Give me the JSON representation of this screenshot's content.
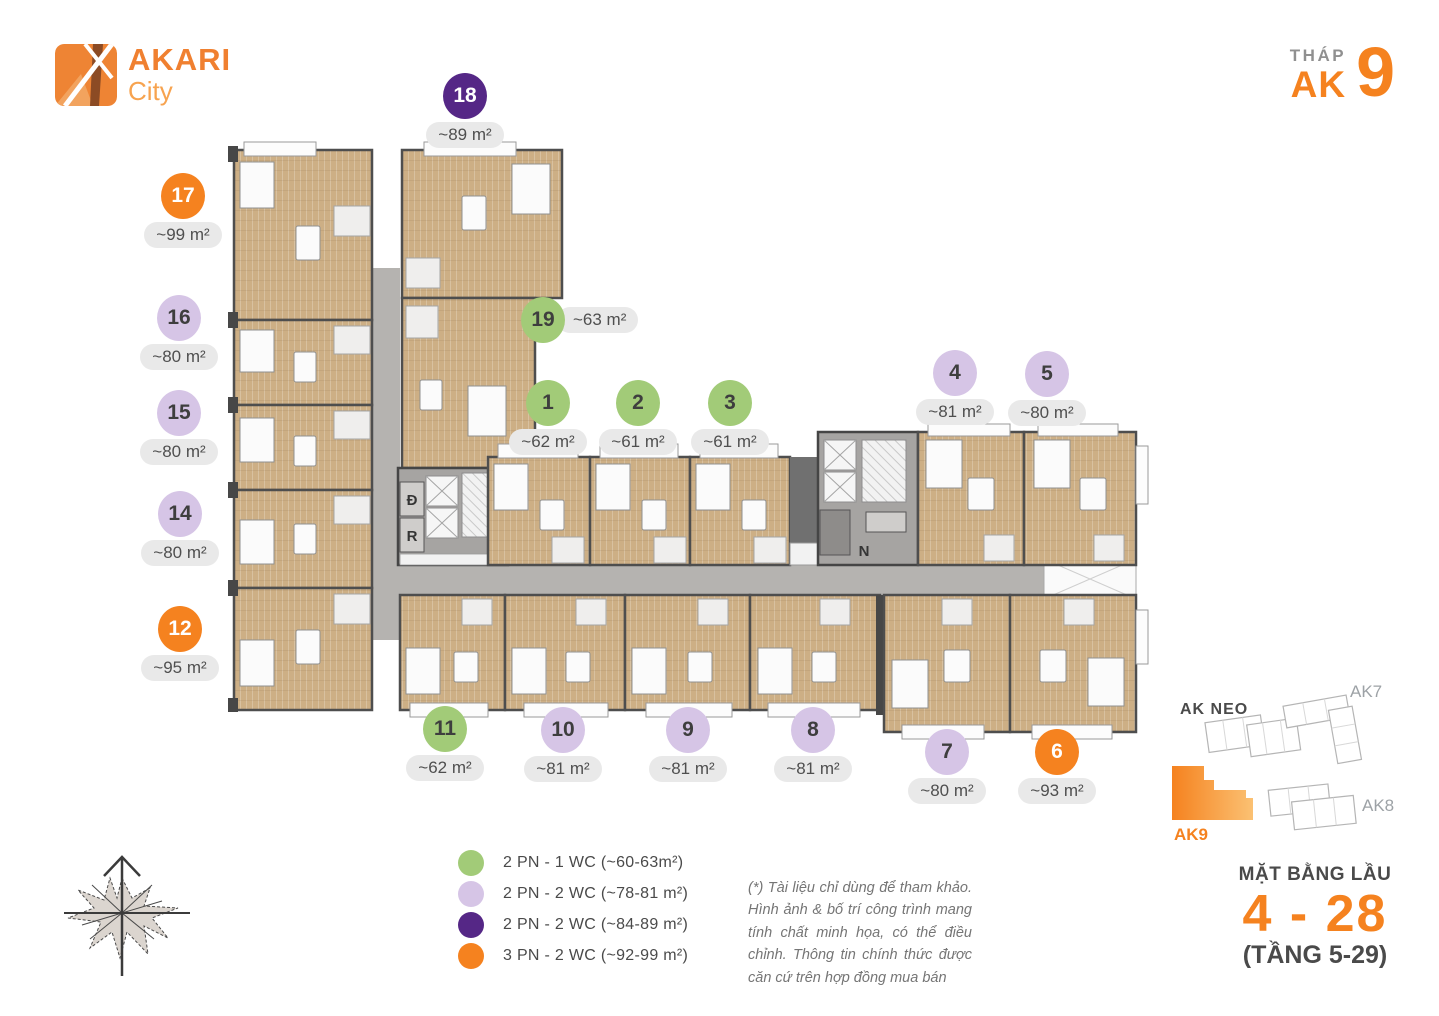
{
  "brand": {
    "title": "AKARI",
    "subtitle": "City"
  },
  "header": {
    "tower_label": "THÁP",
    "tower_prefix": "AK",
    "tower_number": "9"
  },
  "units": [
    {
      "no": "1",
      "area": "~62 m²",
      "type": "2 PN - 1 WC",
      "color": "#A2CB78"
    },
    {
      "no": "2",
      "area": "~61 m²",
      "type": "2 PN - 1 WC",
      "color": "#A2CB78"
    },
    {
      "no": "3",
      "area": "~61 m²",
      "type": "2 PN - 1 WC",
      "color": "#A2CB78"
    },
    {
      "no": "4",
      "area": "~81 m²",
      "type": "2 PN - 2 WC",
      "color": "#D6C5E6"
    },
    {
      "no": "5",
      "area": "~80 m²",
      "type": "2 PN - 2 WC",
      "color": "#D6C5E6"
    },
    {
      "no": "6",
      "area": "~93 m²",
      "type": "3 PN - 2 WC",
      "color": "#F5821F"
    },
    {
      "no": "7",
      "area": "~80 m²",
      "type": "2 PN - 2 WC",
      "color": "#D6C5E6"
    },
    {
      "no": "8",
      "area": "~81 m²",
      "type": "2 PN - 2 WC",
      "color": "#D6C5E6"
    },
    {
      "no": "9",
      "area": "~81 m²",
      "type": "2 PN - 2 WC",
      "color": "#D6C5E6"
    },
    {
      "no": "10",
      "area": "~81 m²",
      "type": "2 PN - 2 WC",
      "color": "#D6C5E6"
    },
    {
      "no": "11",
      "area": "~62 m²",
      "type": "2 PN - 1 WC",
      "color": "#A2CB78"
    },
    {
      "no": "12",
      "area": "~95 m²",
      "type": "3 PN - 2 WC",
      "color": "#F5821F"
    },
    {
      "no": "14",
      "area": "~80 m²",
      "type": "2 PN - 2 WC",
      "color": "#D6C5E6"
    },
    {
      "no": "15",
      "area": "~80 m²",
      "type": "2 PN - 2 WC",
      "color": "#D6C5E6"
    },
    {
      "no": "16",
      "area": "~80 m²",
      "type": "2 PN - 2 WC",
      "color": "#D6C5E6"
    },
    {
      "no": "17",
      "area": "~99 m²",
      "type": "3 PN - 2 WC",
      "color": "#F5821F"
    },
    {
      "no": "18",
      "area": "~89 m²",
      "type": "2 PN - 2 WC",
      "color": "#552786"
    },
    {
      "no": "19",
      "area": "~63 m²",
      "type": "2 PN - 1 WC",
      "color": "#A2CB78"
    }
  ],
  "legend": [
    {
      "label": "2 PN - 1 WC (~60-63m²)",
      "color": "#A2CB78"
    },
    {
      "label": "2 PN - 2 WC (~78-81 m²)",
      "color": "#D6C5E6"
    },
    {
      "label": "2 PN - 2 WC (~84-89 m²)",
      "color": "#552786"
    },
    {
      "label": "3 PN - 2 WC (~92-99 m²)",
      "color": "#F5821F"
    }
  ],
  "disclaimer": "(*) Tài liệu chỉ dùng để tham khảo. Hình ảnh & bố trí công trình mang tính chất minh họa, có thể điều chỉnh. Thông tin chính thức được căn cứ trên hợp đồng mua bán",
  "floor_info": {
    "title": "MẶT BẰNG LẦU",
    "range": "4 - 28",
    "note": "(TẦNG 5-29)"
  },
  "minimap": {
    "labels": {
      "ak_neo": "AK NEO",
      "ak7": "AK7",
      "ak8": "AK8",
      "ak9": "AK9"
    }
  },
  "plan": {
    "core_labels": {
      "d": "Đ",
      "r": "R",
      "n": "N"
    }
  }
}
